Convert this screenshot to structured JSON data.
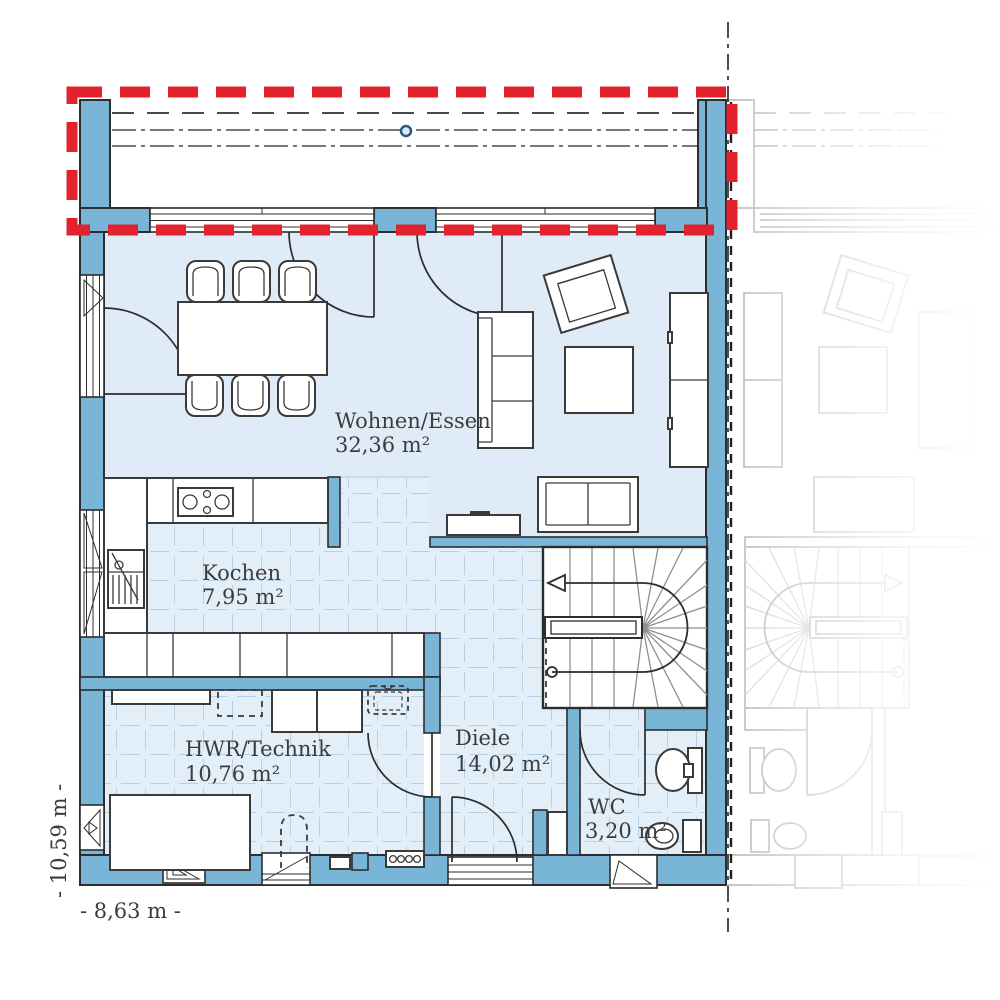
{
  "plan": {
    "rooms": [
      {
        "name": "Wohnen/Essen",
        "area": "32,36 m²"
      },
      {
        "name": "Kochen",
        "area": "7,95 m²"
      },
      {
        "name": "HWR/Technik",
        "area": "10,76 m²"
      },
      {
        "name": "Diele",
        "area": "14,02 m²"
      },
      {
        "name": "WC",
        "area": "3,20 m²"
      }
    ],
    "dimensions": {
      "width": "- 8,63 m -",
      "depth": "- 10,59 m -"
    },
    "colors": {
      "wall": "#79b5d7",
      "floor": "#dfecf7",
      "tile_line": "#b9cfe3",
      "accent_red": "#e2232d",
      "outline": "#2d2d2d",
      "faded": "#bdbdbd",
      "text": "#3c3c3c"
    }
  }
}
